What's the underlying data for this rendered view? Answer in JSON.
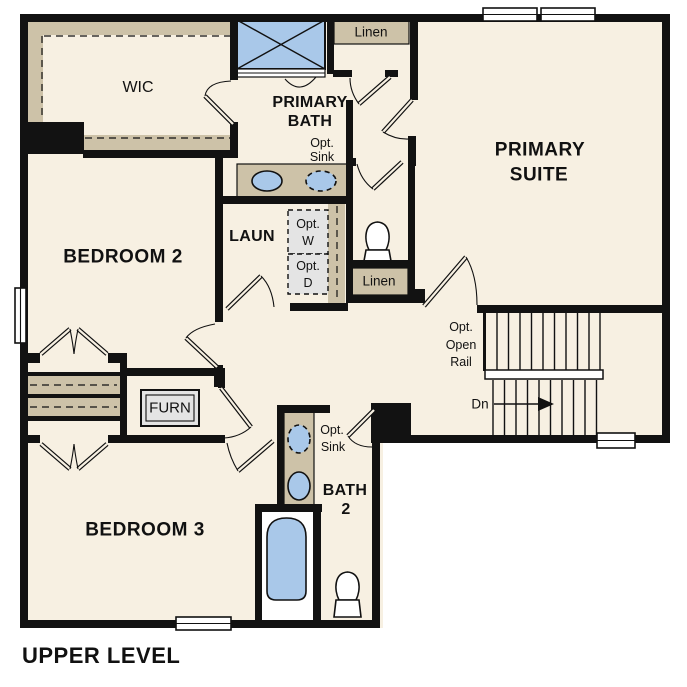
{
  "plan_title": "UPPER LEVEL",
  "labels": {
    "wic": "WIC",
    "primary_bath_1": "PRIMARY",
    "primary_bath_2": "BATH",
    "pb_opt_sink_1": "Opt.",
    "pb_opt_sink_2": "Sink",
    "linen_top": "Linen",
    "primary_suite_1": "PRIMARY",
    "primary_suite_2": "SUITE",
    "laun": "LAUN",
    "opt_w_1": "Opt.",
    "opt_w_2": "W",
    "opt_d_1": "Opt.",
    "opt_d_2": "D",
    "linen_mid": "Linen",
    "opt_rail_1": "Opt.",
    "opt_rail_2": "Open",
    "opt_rail_3": "Rail",
    "dn": "Dn",
    "bedroom_2": "BEDROOM 2",
    "furn": "FURN",
    "bedroom_3": "BEDROOM 3",
    "b2_opt_sink_1": "Opt.",
    "b2_opt_sink_2": "Sink",
    "bath_2_1": "BATH",
    "bath_2_2": "2"
  },
  "colors": {
    "wall": "#121212",
    "floor": "#f7f0e2",
    "tan": "#cdc2a8",
    "blue": "#a9c8e9",
    "gray": "#e4e4e4"
  }
}
